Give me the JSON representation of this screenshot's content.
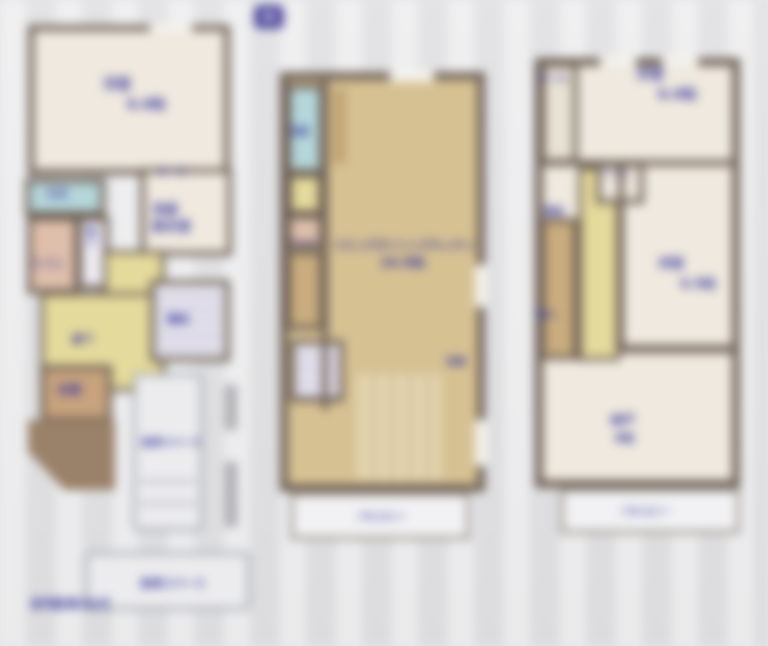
{
  "colors": {
    "background": "#e7e7e9",
    "wall": "#6f6156",
    "room_cream": "#efe9df",
    "room_tan": "#d6c193",
    "room_yellow": "#e4da9c",
    "room_bath_blue": "#b5d6da",
    "room_pink": "#debfab",
    "label_blue": "#3b3b9d"
  },
  "plan1f": {
    "bedroom_label": "洋室",
    "bedroom_size": "6.0帖",
    "hall_small_label": "ホール",
    "washroom_line1": "洗面",
    "washroom_line2": "脱衣室",
    "bath_label": "浴室",
    "toilet_label": "トイレ",
    "storage_label": "物入",
    "corridor_label": "廊下",
    "stairs_label": "階段",
    "entrance_label": "玄関",
    "parking1_label": "駐車スペース",
    "parking2_label": "駐車スペース",
    "note_label": "並列駐車2台可"
  },
  "plan2f": {
    "north_label": "N",
    "washstand_label": "洗面",
    "toilet_label": "トイレ",
    "ldk_line1": "リビングダイニングキッチン",
    "ldk_line2": "16.0帖",
    "storage_label": "収納",
    "balcony_label": "バルコニー"
  },
  "plan3f": {
    "hall_label": "ホール",
    "bedroom1_label": "洋室",
    "bedroom1_size": "6.0帖",
    "toilet_label": "トイレ",
    "stairs_label": "階段",
    "closet_label": "物入",
    "bedroom2_label": "洋室",
    "bedroom2_size": "4.5帖",
    "storage_room_label": "納戸",
    "storage_room_size": "4帖",
    "balcony_label": "バルコニー"
  }
}
